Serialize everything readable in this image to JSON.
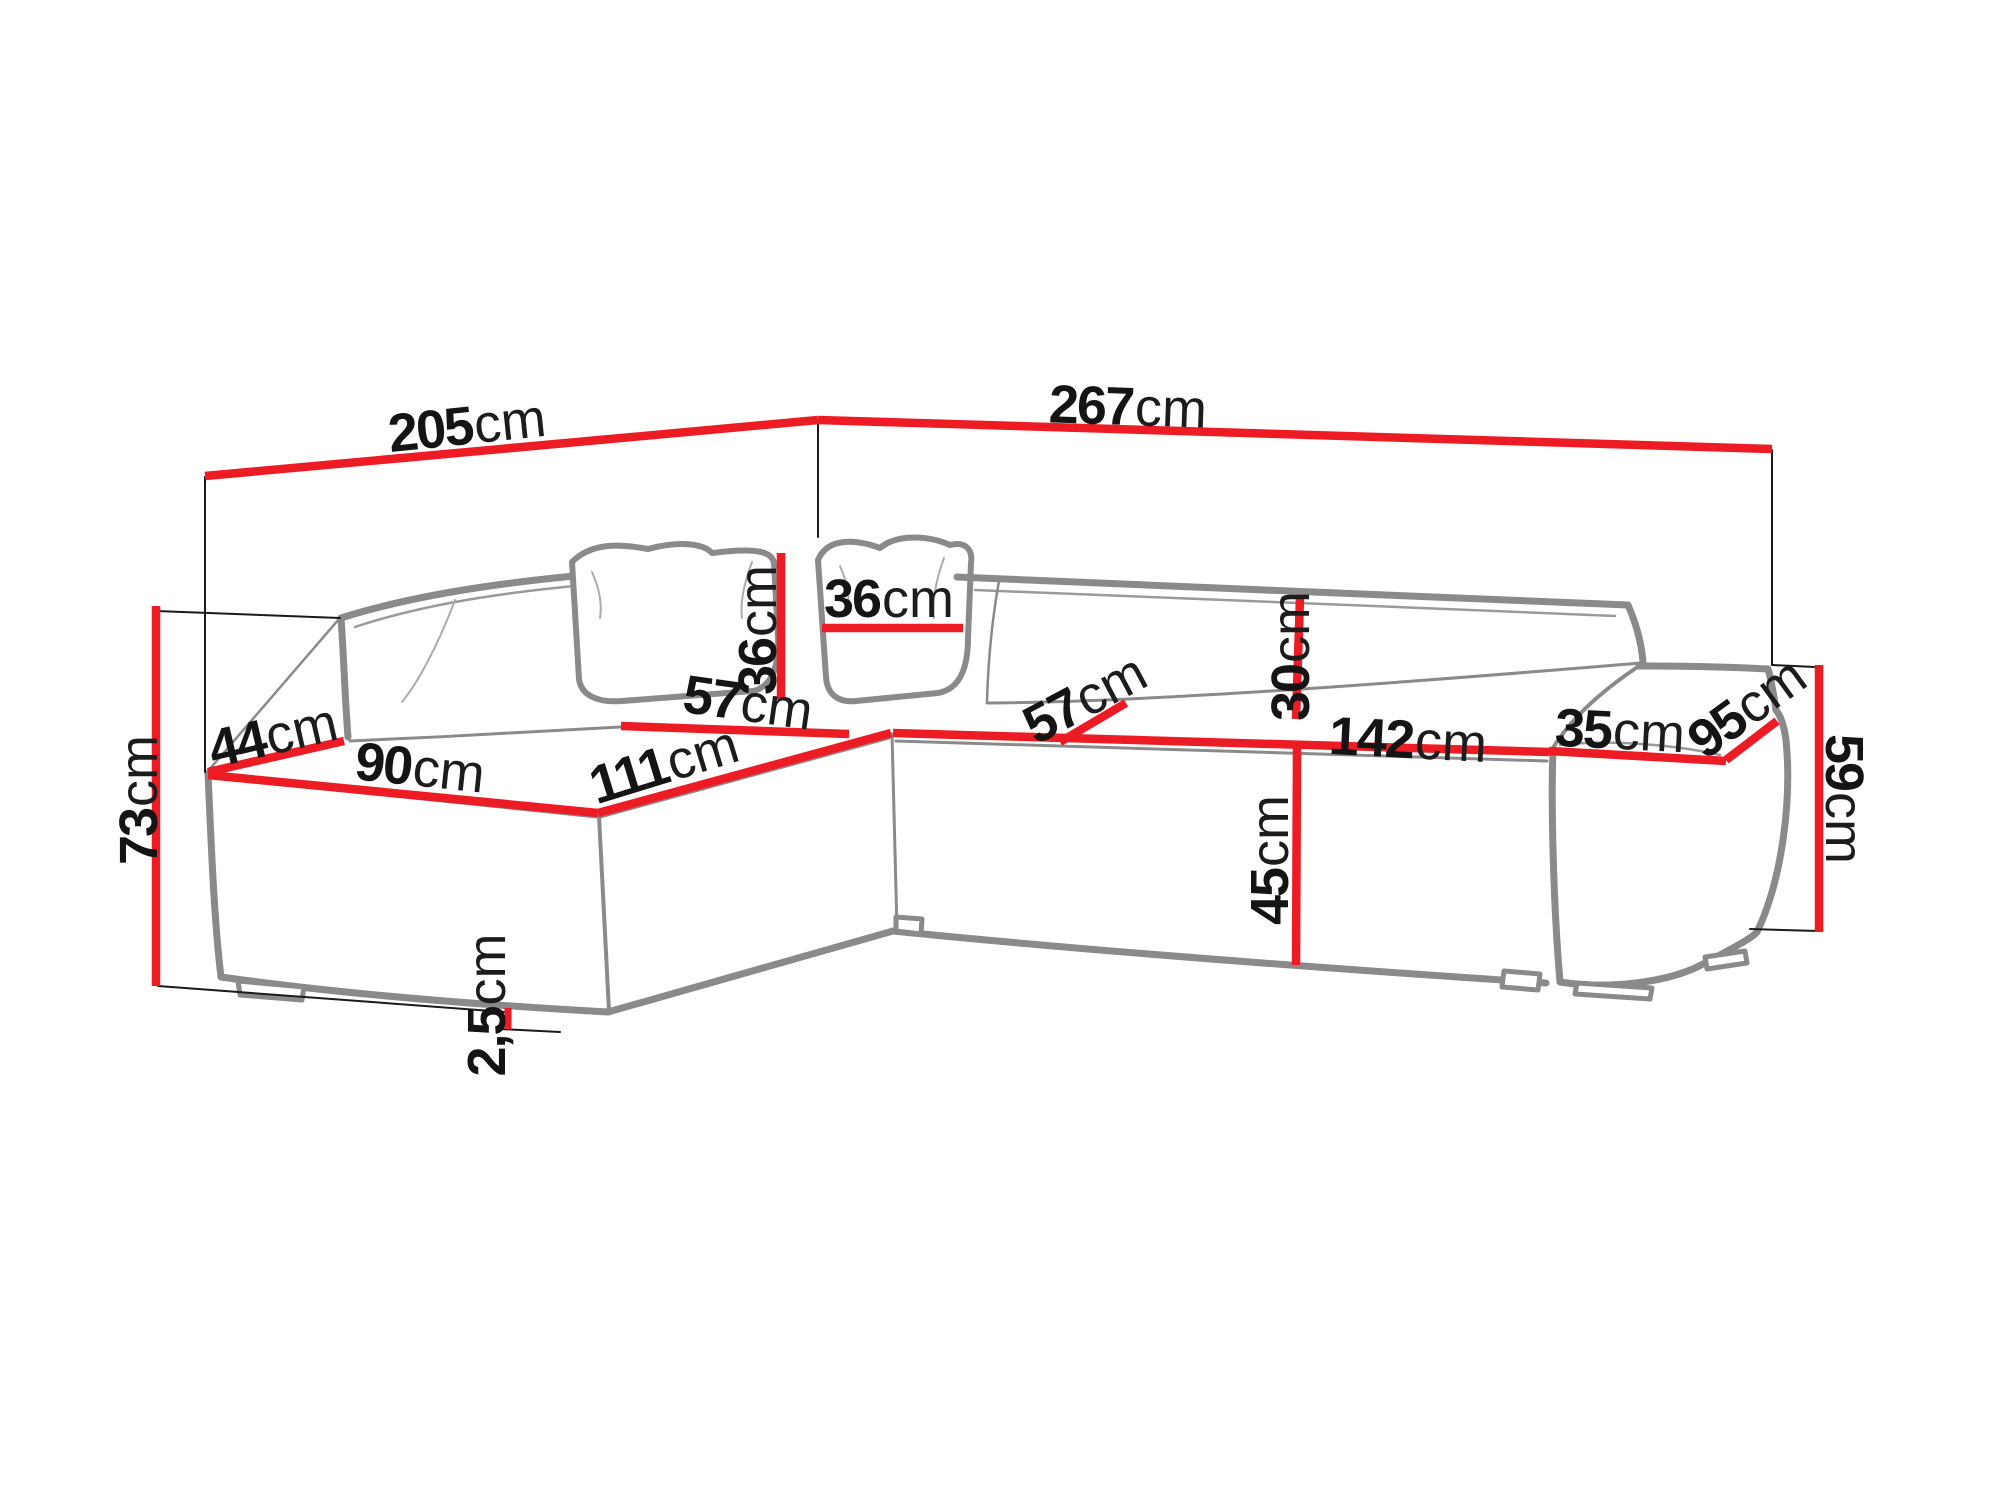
{
  "figure": {
    "subject": "corner sofa with chaise and ottoman - technical dimension line drawing",
    "background_color": "#ffffff",
    "outline_color": "#8a8a8a",
    "accent_red": "#ec1b24",
    "helper_line_color": "#1a1a1a",
    "text_color": "#141414"
  },
  "dimensions": {
    "d205": {
      "num": "205",
      "unit": "cm",
      "meaning": "overall depth along left wall"
    },
    "d267": {
      "num": "267",
      "unit": "cm",
      "meaning": "overall width along back wall"
    },
    "d73": {
      "num": "73",
      "unit": "cm",
      "meaning": "total height left side"
    },
    "d44": {
      "num": "44",
      "unit": "cm",
      "meaning": "armrest top width"
    },
    "d90": {
      "num": "90",
      "unit": "cm",
      "meaning": "chaise front edge width"
    },
    "d111": {
      "num": "111",
      "unit": "cm",
      "meaning": "chaise seat length"
    },
    "d57l": {
      "num": "57",
      "unit": "cm",
      "meaning": "seat depth left section"
    },
    "d36v": {
      "num": "36",
      "unit": "cm",
      "meaning": "pillow height"
    },
    "d36h": {
      "num": "36",
      "unit": "cm",
      "meaning": "pillow width"
    },
    "d57r": {
      "num": "57",
      "unit": "cm",
      "meaning": "seat depth right section"
    },
    "d30": {
      "num": "30",
      "unit": "cm",
      "meaning": "backrest cushion height"
    },
    "d142": {
      "num": "142",
      "unit": "cm",
      "meaning": "seat front edge length"
    },
    "d45": {
      "num": "45",
      "unit": "cm",
      "meaning": "seat height"
    },
    "d35": {
      "num": "35",
      "unit": "cm",
      "meaning": "ottoman top width"
    },
    "d95": {
      "num": "95",
      "unit": "cm",
      "meaning": "ottoman top depth"
    },
    "d59": {
      "num": "59",
      "unit": "cm",
      "meaning": "ottoman height"
    },
    "d25": {
      "num": "2,5",
      "unit": "cm",
      "meaning": "leg / clearance height"
    }
  }
}
